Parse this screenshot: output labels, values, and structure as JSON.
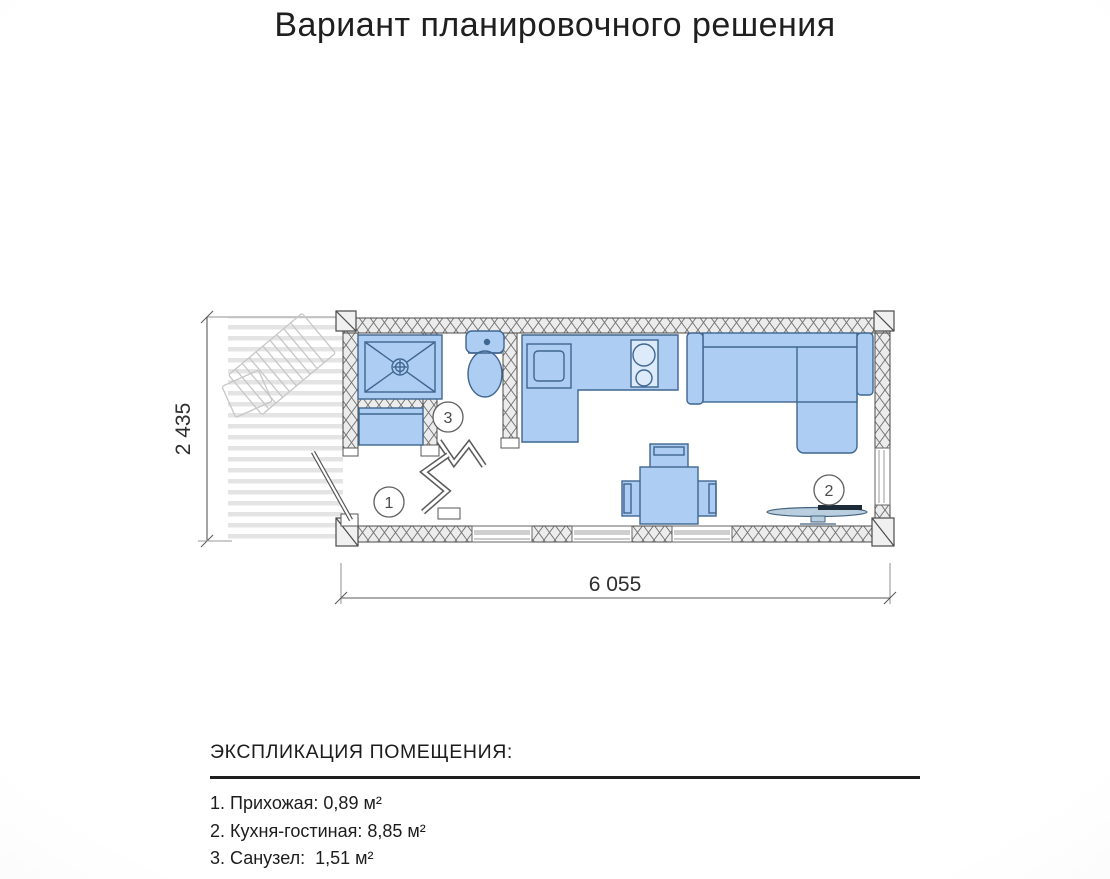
{
  "title": "Вариант планировочного решения",
  "plan": {
    "dimensions": {
      "width": "6 055",
      "height": "2 435"
    },
    "markers": {
      "hallway": "1",
      "living": "2",
      "bath": "3"
    },
    "colors": {
      "furniture_fill": "#aecdf2",
      "furniture_stroke": "#3f6690",
      "wall_hatch_bg": "#ececec",
      "wall_line": "#4a4a4a",
      "deck_stripe": "#e4e4e4",
      "dimension": "#3c3c3c"
    }
  },
  "legend": {
    "heading": "ЭКСПЛИКАЦИЯ ПОМЕЩЕНИЯ:",
    "items": [
      {
        "number": "1",
        "name": "Прихожая",
        "area_m2": "0,89",
        "text": "1. Прихожая: 0,89 м²"
      },
      {
        "number": "2",
        "name": "Кухня-гостиная",
        "area_m2": "8,85",
        "text": "2. Кухня-гостиная: 8,85 м²"
      },
      {
        "number": "3",
        "name": "Санузел",
        "area_m2": "1,51",
        "text": "3. Санузел:  1,51 м²"
      }
    ]
  }
}
